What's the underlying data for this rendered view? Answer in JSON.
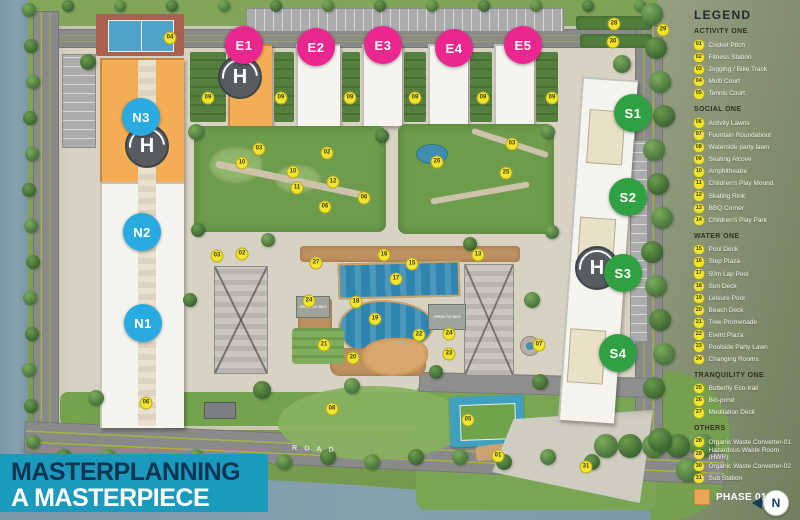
{
  "title_banner": {
    "line1": "MASTERPLANNING",
    "line2": "A MASTERPIECE"
  },
  "legend": {
    "title": "LEGEND",
    "phase_label": "PHASE 01",
    "compass_n": "N",
    "sections": [
      {
        "name": "ACTIVITY ONE",
        "items": [
          {
            "num": "01",
            "label": "Cricket Pitch"
          },
          {
            "num": "02",
            "label": "Fitness Station"
          },
          {
            "num": "03",
            "label": "Jogging / Bike Track"
          },
          {
            "num": "04",
            "label": "Multi Court"
          },
          {
            "num": "05",
            "label": "Tennis Court"
          }
        ]
      },
      {
        "name": "SOCIAL ONE",
        "items": [
          {
            "num": "06",
            "label": "Activity Lawns"
          },
          {
            "num": "07",
            "label": "Fountain Roundabout"
          },
          {
            "num": "08",
            "label": "Waterside party lawn"
          },
          {
            "num": "09",
            "label": "Seating Alcove"
          },
          {
            "num": "10",
            "label": "Amphitheatre"
          },
          {
            "num": "11",
            "label": "Children's Play Mound"
          },
          {
            "num": "12",
            "label": "Skating Rink"
          },
          {
            "num": "13",
            "label": "BBQ Corner"
          },
          {
            "num": "14",
            "label": "Children's Play Park"
          }
        ]
      },
      {
        "name": "WATER ONE",
        "items": [
          {
            "num": "15",
            "label": "Pool Deck"
          },
          {
            "num": "16",
            "label": "Step Plaza"
          },
          {
            "num": "17",
            "label": "50m Lap Pool"
          },
          {
            "num": "18",
            "label": "Sun Deck"
          },
          {
            "num": "19",
            "label": "Leisure Pool"
          },
          {
            "num": "20",
            "label": "Beach Deck"
          },
          {
            "num": "21",
            "label": "Tree Promenade"
          },
          {
            "num": "22",
            "label": "Event Plaza"
          },
          {
            "num": "23",
            "label": "Poolside Party Lawn"
          },
          {
            "num": "24",
            "label": "Changing Rooms"
          }
        ]
      },
      {
        "name": "TRANQUILITY ONE",
        "items": [
          {
            "num": "25",
            "label": "Butterfly Eco-trail"
          },
          {
            "num": "26",
            "label": "Bio-pond"
          },
          {
            "num": "27",
            "label": "Meditation Deck"
          }
        ]
      },
      {
        "name": "OTHERS",
        "items": [
          {
            "num": "28",
            "label": "Organic Waste Converter-01"
          },
          {
            "num": "29",
            "label": "Hazardous Waste Room (HWR)"
          },
          {
            "num": "30",
            "label": "Organic Waste Converter-02"
          },
          {
            "num": "31",
            "label": "Sub Station"
          }
        ]
      }
    ]
  },
  "map": {
    "road_label": "ROAD",
    "open_to_sky": "OPEN TO SKY",
    "helipad_letter": "H",
    "blocks": [
      {
        "id": "E1",
        "color": "pink",
        "x": 244,
        "y": 45
      },
      {
        "id": "E2",
        "color": "pink",
        "x": 316,
        "y": 47
      },
      {
        "id": "E3",
        "color": "pink",
        "x": 383,
        "y": 45
      },
      {
        "id": "E4",
        "color": "pink",
        "x": 454,
        "y": 48
      },
      {
        "id": "E5",
        "color": "pink",
        "x": 523,
        "y": 45
      },
      {
        "id": "N3",
        "color": "blue",
        "x": 141,
        "y": 117
      },
      {
        "id": "N2",
        "color": "blue",
        "x": 142,
        "y": 232
      },
      {
        "id": "N1",
        "color": "blue",
        "x": 143,
        "y": 323
      },
      {
        "id": "S1",
        "color": "green",
        "x": 633,
        "y": 113
      },
      {
        "id": "S2",
        "color": "green",
        "x": 628,
        "y": 197
      },
      {
        "id": "S3",
        "color": "green",
        "x": 623,
        "y": 273
      },
      {
        "id": "S4",
        "color": "green",
        "x": 618,
        "y": 353
      }
    ],
    "markers": [
      {
        "n": "04",
        "x": 170,
        "y": 38
      },
      {
        "n": "28",
        "x": 614,
        "y": 24
      },
      {
        "n": "30",
        "x": 613,
        "y": 42
      },
      {
        "n": "29",
        "x": 663,
        "y": 30
      },
      {
        "n": "09",
        "x": 208,
        "y": 98
      },
      {
        "n": "09",
        "x": 281,
        "y": 98
      },
      {
        "n": "09",
        "x": 350,
        "y": 98
      },
      {
        "n": "09",
        "x": 415,
        "y": 98
      },
      {
        "n": "09",
        "x": 483,
        "y": 98
      },
      {
        "n": "09",
        "x": 552,
        "y": 98
      },
      {
        "n": "03",
        "x": 259,
        "y": 149
      },
      {
        "n": "02",
        "x": 327,
        "y": 153
      },
      {
        "n": "10",
        "x": 242,
        "y": 163
      },
      {
        "n": "10",
        "x": 293,
        "y": 172
      },
      {
        "n": "11",
        "x": 297,
        "y": 188
      },
      {
        "n": "12",
        "x": 333,
        "y": 182
      },
      {
        "n": "06",
        "x": 364,
        "y": 198
      },
      {
        "n": "06",
        "x": 325,
        "y": 207
      },
      {
        "n": "03",
        "x": 217,
        "y": 256
      },
      {
        "n": "02",
        "x": 242,
        "y": 254
      },
      {
        "n": "27",
        "x": 316,
        "y": 263
      },
      {
        "n": "16",
        "x": 384,
        "y": 255
      },
      {
        "n": "15",
        "x": 412,
        "y": 264
      },
      {
        "n": "13",
        "x": 478,
        "y": 255
      },
      {
        "n": "17",
        "x": 396,
        "y": 279
      },
      {
        "n": "03",
        "x": 512,
        "y": 144
      },
      {
        "n": "26",
        "x": 437,
        "y": 162
      },
      {
        "n": "25",
        "x": 506,
        "y": 173
      },
      {
        "n": "24",
        "x": 309,
        "y": 301
      },
      {
        "n": "18",
        "x": 356,
        "y": 302
      },
      {
        "n": "19",
        "x": 375,
        "y": 319
      },
      {
        "n": "22",
        "x": 419,
        "y": 335
      },
      {
        "n": "24",
        "x": 449,
        "y": 334
      },
      {
        "n": "21",
        "x": 324,
        "y": 345
      },
      {
        "n": "20",
        "x": 353,
        "y": 358
      },
      {
        "n": "23",
        "x": 449,
        "y": 354
      },
      {
        "n": "07",
        "x": 539,
        "y": 345
      },
      {
        "n": "06",
        "x": 146,
        "y": 403
      },
      {
        "n": "08",
        "x": 332,
        "y": 409
      },
      {
        "n": "05",
        "x": 468,
        "y": 420
      },
      {
        "n": "01",
        "x": 498,
        "y": 456
      },
      {
        "n": "31",
        "x": 586,
        "y": 467
      }
    ]
  },
  "colors": {
    "pink": "#EC268F",
    "blue": "#29ABE2",
    "green": "#2FA143",
    "marker_yellow": "#F3E42C",
    "phase_orange": "#EBA757",
    "banner_teal": "#1A9ABD",
    "navy": "#0D3553"
  }
}
